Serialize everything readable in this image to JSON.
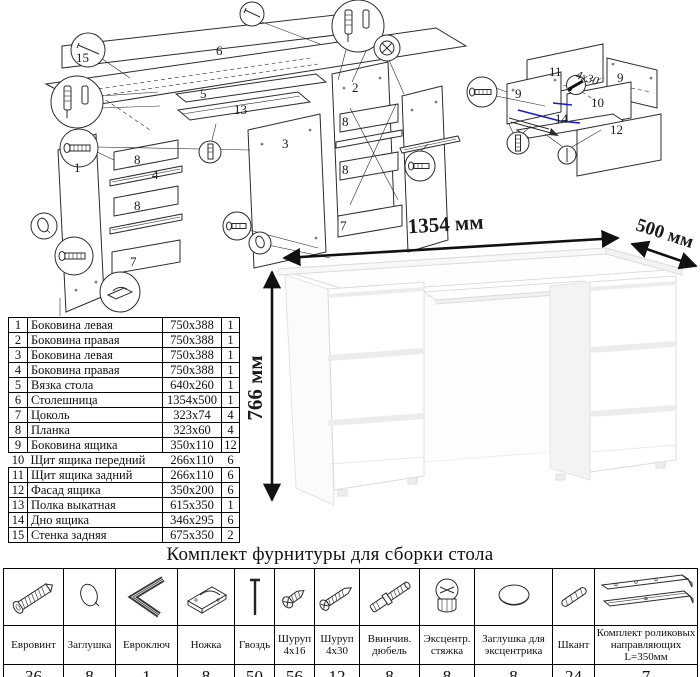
{
  "page": {
    "background": "#ffffff",
    "line_color": "#2b2b2b",
    "highlight_blue": "#1a1acd"
  },
  "diagram_main": {
    "labels": {
      "back_panel": "15",
      "desktop": "6",
      "left_side": "1",
      "right_side": "2",
      "divider": "3",
      "rail": "4",
      "base": "5",
      "plank": "8",
      "plinth": "7",
      "shelf": "13"
    }
  },
  "diagram_drawer": {
    "labels": {
      "back": "11",
      "side": "9",
      "front_inner": "10",
      "bottom": "14",
      "facade": "12"
    },
    "screw_note": "4x30"
  },
  "desk_drawing": {
    "width_label": "1354 мм",
    "depth_label": "500 мм",
    "height_label": "766 мм"
  },
  "parts_table": {
    "rows": [
      {
        "num": "1",
        "name": "Боковина левая",
        "size": "750x388",
        "qty": "1"
      },
      {
        "num": "2",
        "name": "Боковина правая",
        "size": "750x388",
        "qty": "1"
      },
      {
        "num": "3",
        "name": "Боковина левая",
        "size": "750x388",
        "qty": "1"
      },
      {
        "num": "4",
        "name": "Боковина правая",
        "size": "750x388",
        "qty": "1"
      },
      {
        "num": "5",
        "name": "Вязка стола",
        "size": "640x260",
        "qty": "1"
      },
      {
        "num": "6",
        "name": "Столешница",
        "size": "1354x500",
        "qty": "1"
      },
      {
        "num": "7",
        "name": "Цоколь",
        "size": "323x74",
        "qty": "4"
      },
      {
        "num": "8",
        "name": "Планка",
        "size": "323x60",
        "qty": "4"
      },
      {
        "num": "9",
        "name": "Боковина ящика",
        "size": "350x110",
        "qty": "12"
      },
      {
        "num": "10",
        "name": "Щит ящика передний",
        "size": "266x110",
        "qty": "6"
      },
      {
        "num": "11",
        "name": "Щит ящика задний",
        "size": "266x110",
        "qty": "6"
      },
      {
        "num": "12",
        "name": "Фасад ящика",
        "size": "350x200",
        "qty": "6"
      },
      {
        "num": "13",
        "name": "Полка выкатная",
        "size": "615x350",
        "qty": "1"
      },
      {
        "num": "14",
        "name": "Дно ящика",
        "size": "346x295",
        "qty": "6"
      },
      {
        "num": "15",
        "name": "Стенка задняя",
        "size": "675x350",
        "qty": "2"
      }
    ]
  },
  "hardware": {
    "title": "Комплект фурнитуры для сборки стола",
    "items": [
      {
        "name": "Евровинт",
        "qty": "36",
        "icon": "euroscrew-icon"
      },
      {
        "name": "Заглушка",
        "qty": "8",
        "icon": "cap-icon"
      },
      {
        "name": "Евроключ",
        "qty": "1",
        "icon": "hexkey-icon"
      },
      {
        "name": "Ножка",
        "qty": "8",
        "icon": "foot-icon"
      },
      {
        "name": "Гвоздь",
        "qty": "50",
        "icon": "nail-icon"
      },
      {
        "name": "Шуруп 4x16",
        "qty": "56",
        "icon": "screw-4x16-icon"
      },
      {
        "name": "Шуруп 4x30",
        "qty": "12",
        "icon": "screw-4x30-icon"
      },
      {
        "name": "Ввинчив. дюбель",
        "qty": "8",
        "icon": "screw-dowel-icon"
      },
      {
        "name": "Эксцентр. стяжка",
        "qty": "8",
        "icon": "cam-lock-icon"
      },
      {
        "name": "Заглушка для эксцентрика",
        "qty": "8",
        "icon": "cam-cap-icon"
      },
      {
        "name": "Шкант",
        "qty": "24",
        "icon": "dowel-icon"
      },
      {
        "name": "Комплект роликовых направляющих L=350мм",
        "qty": "7",
        "icon": "drawer-slides-icon"
      }
    ]
  }
}
